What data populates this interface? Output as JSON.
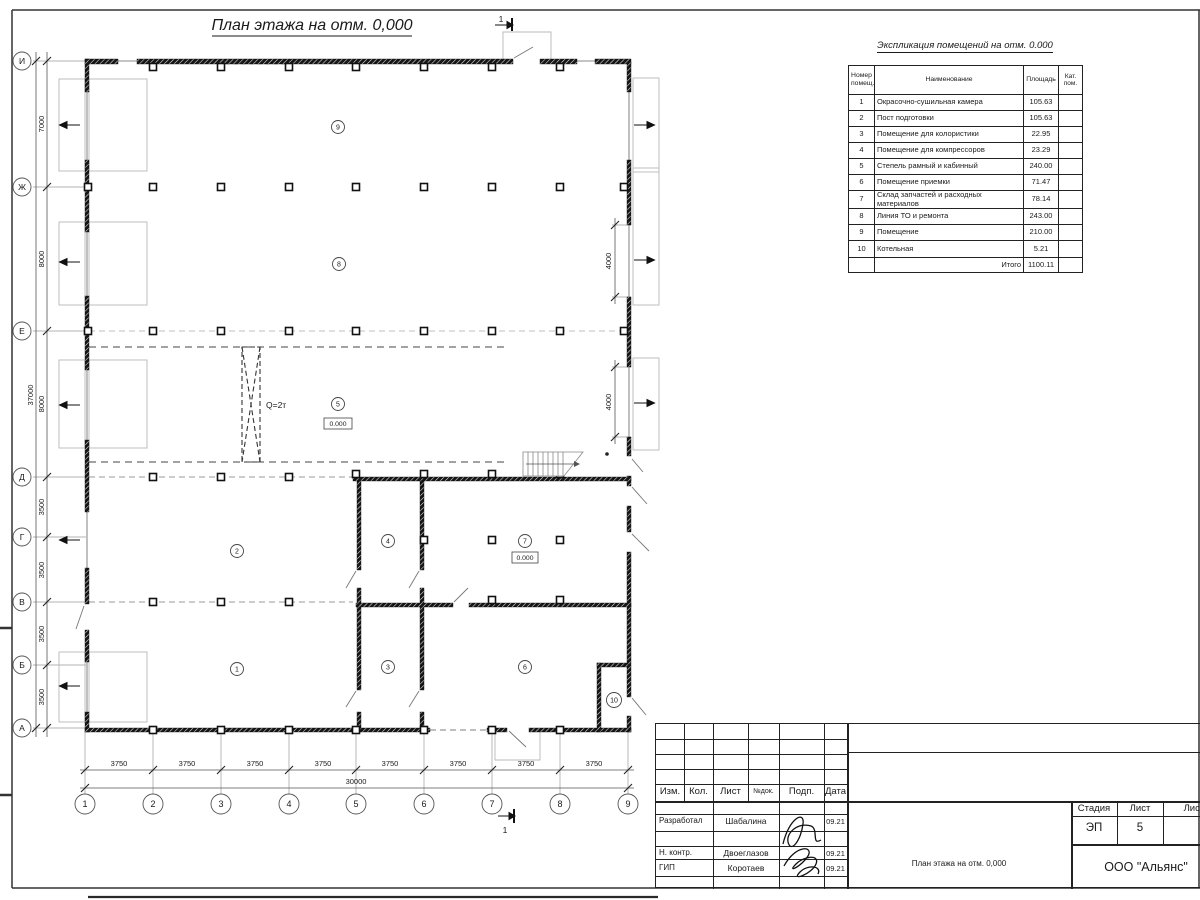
{
  "sheet": {
    "title": "План этажа на отм. 0,000",
    "section_mark": "1"
  },
  "plan": {
    "row_axes": [
      "И",
      "Ж",
      "Е",
      "Д",
      "Г",
      "В",
      "Б",
      "А"
    ],
    "col_axes": [
      "1",
      "2",
      "3",
      "4",
      "5",
      "6",
      "7",
      "8",
      "9"
    ],
    "dims_left": [
      "7000",
      "8000",
      "8000",
      "3500",
      "3500",
      "3500",
      "3500"
    ],
    "dims_left_total": "37000",
    "dims_bottom": [
      "3750",
      "3750",
      "3750",
      "3750",
      "3750",
      "3750",
      "3750",
      "3750"
    ],
    "dims_bottom_total": "30000",
    "dims_right": [
      "4000",
      "4000"
    ],
    "rooms": [
      "1",
      "2",
      "3",
      "4",
      "5",
      "6",
      "7",
      "8",
      "9",
      "10"
    ],
    "crane_label": "Q=2т",
    "elevation": "0.000",
    "ink_color": "#1a1a1a",
    "construction_color": "#b0b0b0"
  },
  "schedule": {
    "title": "Экспликация помещений на отм. 0.000",
    "header": {
      "number_l1": "Номер",
      "number_l2": "помещ.",
      "name": "Наименование",
      "area": "Площадь",
      "cat_l1": "Кат.",
      "cat_l2": "пом."
    },
    "rows": [
      {
        "num": "1",
        "name": "Окрасочно-сушильная камера",
        "area": "105.63"
      },
      {
        "num": "2",
        "name": "Пост подготовки",
        "area": "105.63"
      },
      {
        "num": "3",
        "name": "Помещение для колористики",
        "area": "22.95"
      },
      {
        "num": "4",
        "name": "Помещение для компрессоров",
        "area": "23.29"
      },
      {
        "num": "5",
        "name": "Степель рамный и кабинный",
        "area": "240.00"
      },
      {
        "num": "6",
        "name": "Помещение приемки",
        "area": "71.47"
      },
      {
        "num": "7",
        "name": "Склад запчастей и расходных материалов",
        "area": "78.14"
      },
      {
        "num": "8",
        "name": "Линия ТО и ремонта",
        "area": "243.00"
      },
      {
        "num": "9",
        "name": "Помещение",
        "area": "210.00"
      },
      {
        "num": "10",
        "name": "Котельная",
        "area": "5.21"
      }
    ],
    "total_label": "Итого",
    "total_value": "1100.11"
  },
  "title_block": {
    "cols": [
      "Изм.",
      "Кол.",
      "Лист",
      "№док.",
      "Подп.",
      "Дата"
    ],
    "people": [
      {
        "role": "Разработал",
        "name": "Шабалина",
        "date": "09.21"
      },
      {
        "role": "Н. контр.",
        "name": "Двоеглазов",
        "date": "09.21"
      },
      {
        "role": "ГИП",
        "name": "Коротаев",
        "date": "09.21"
      }
    ],
    "stage_label": "Стадия",
    "sheet_label": "Лист",
    "sheets_label": "Листов",
    "stage": "ЭП",
    "sheet_no": "5",
    "doc_title": "План этажа на отм. 0,000",
    "company": "ООО \"Альянс\""
  }
}
